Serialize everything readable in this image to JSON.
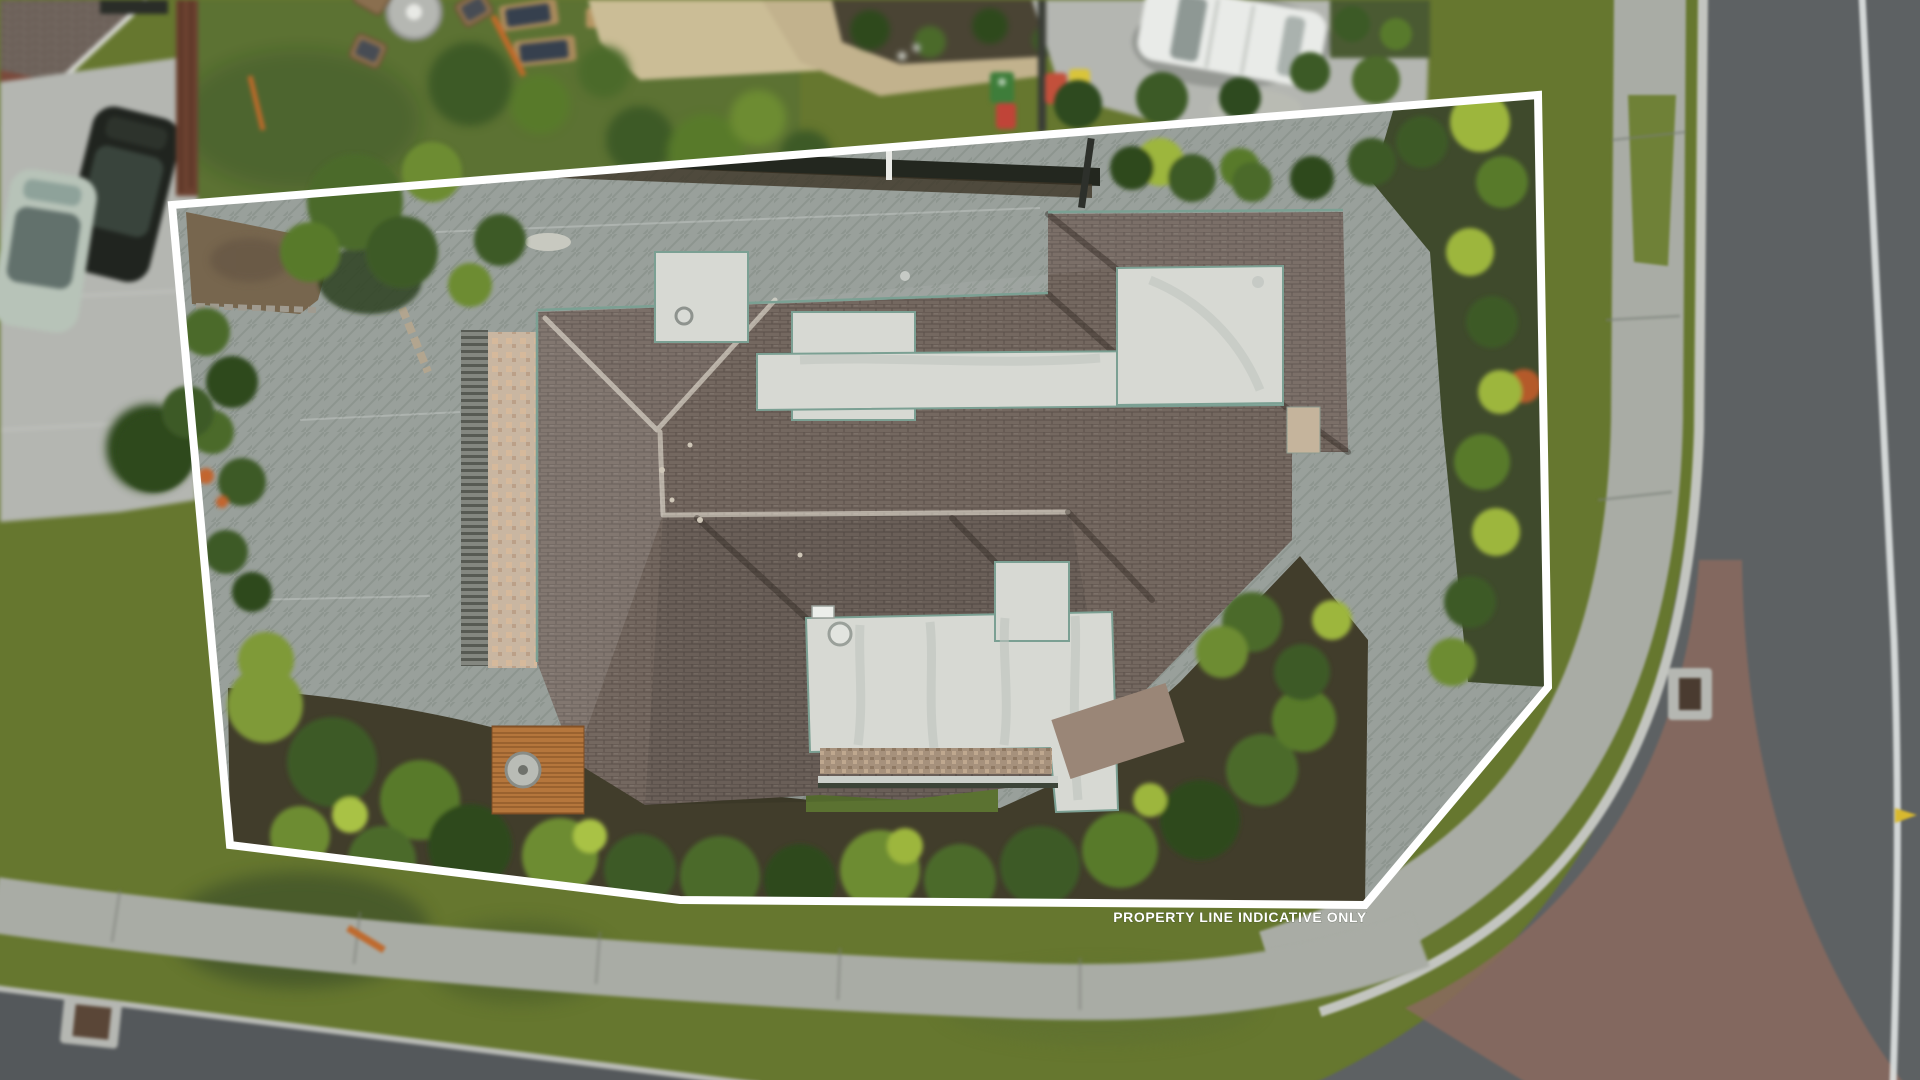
{
  "overlay": {
    "label": "PROPERTY LINE INDICATIVE ONLY",
    "line_color": "#ffffff",
    "line_width": 8,
    "property_line_points": "172,205 1538,95 1548,687 1365,905 680,900 230,845"
  },
  "palette": {
    "grass": "#66772f",
    "neighbor_lawn": "#5c7233",
    "road": "#5d6163",
    "road_dark": "#54585b",
    "concrete": "#b4b6b1",
    "footpath": "#a9aca5",
    "curb": "#c3c5c0",
    "paving": "#99a09b",
    "roof_shingle": "#746860",
    "roof_white": "#d7d9d3",
    "roof_edge_teal": "#7ba093",
    "mulch": "#413d2b",
    "right_mulch": "#3f4a2c",
    "chipseal": "#8a6a5e",
    "terrace_tile": "#c9b6a1",
    "timber": "#b5763c",
    "dirt": "#77664e",
    "white_suv": "#e9ebe8",
    "black_car": "#20241f",
    "teal_car": "#b7c3b8",
    "bin_green": "#3e7d3a",
    "bin_red": "#c04438",
    "bin_orange": "#c3503b",
    "bin_yellow": "#d9c43a",
    "road_line": "#dfe3e2",
    "arrow_yellow": "#d8b92f",
    "fence_brown": "#6b4130",
    "dark_fence": "#23271f"
  }
}
